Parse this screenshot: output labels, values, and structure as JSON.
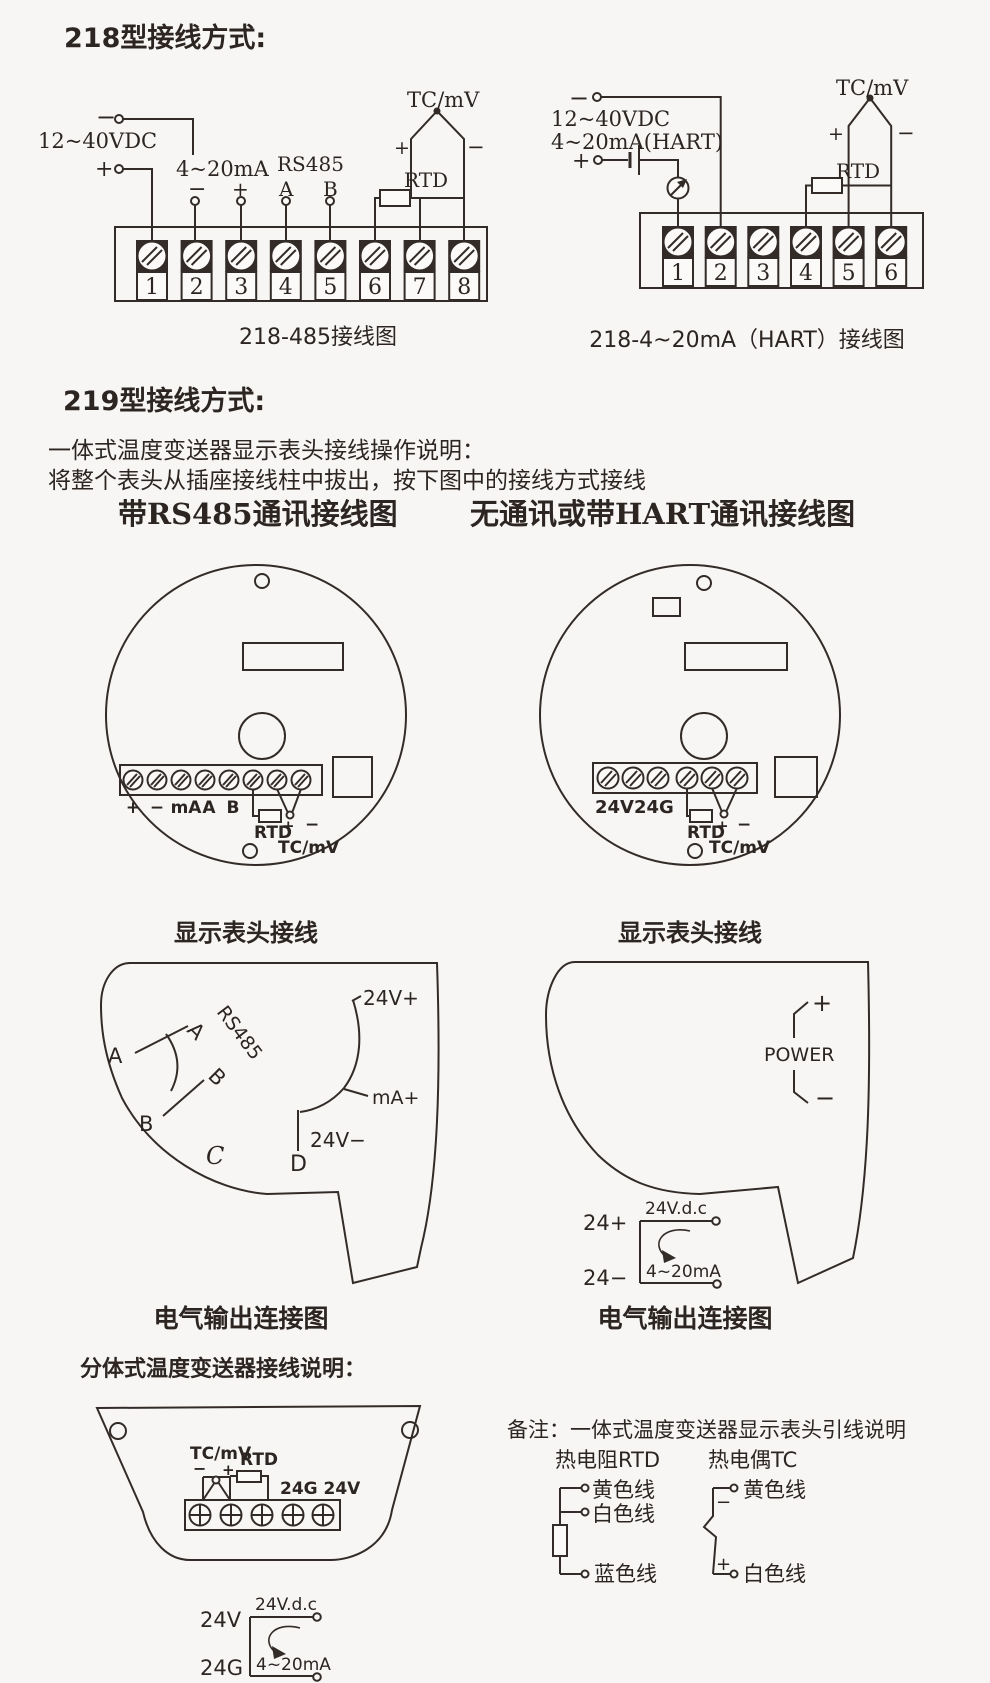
{
  "colors": {
    "ink": "#332b27",
    "bg": "#f7f6f4"
  },
  "s218": {
    "title": "218型接线方式:",
    "left": {
      "caption": "218-485接线图",
      "supply": "12~40VDC",
      "supply_minus": "−",
      "supply_plus": "+",
      "loop": "4~20mA",
      "loop_minus": "−",
      "loop_plus": "+",
      "rs485": "RS485",
      "a": "A",
      "b": "B",
      "tcmv": "TC/mV",
      "tc_plus": "+",
      "tc_minus": "−",
      "rtd": "RTD",
      "terminals": [
        "1",
        "2",
        "3",
        "4",
        "5",
        "6",
        "7",
        "8"
      ]
    },
    "right": {
      "caption": "218-4~20mA（HART）接线图",
      "supply": "12~40VDC",
      "supply2": "4~20mA(HART)",
      "supply_minus": "−",
      "supply_plus": "+",
      "tcmv": "TC/mV",
      "tc_plus": "+",
      "tc_minus": "−",
      "rtd": "RTD",
      "terminals": [
        "1",
        "2",
        "3",
        "4",
        "5",
        "6"
      ]
    }
  },
  "s219": {
    "title": "219型接线方式:",
    "desc1": "一体式温度变送器显示表头接线操作说明：",
    "desc2": "将整个表头从插座接线柱中拔出，按下图中的接线方式接线",
    "left_header": "带RS485通讯接线图",
    "right_header": "无通讯或带HART通讯接线图",
    "head_caption": "显示表头接线",
    "out_caption": "电气输出连接图",
    "left_circle": {
      "t_plus": "+",
      "t_minus": "−",
      "t_ma": "mA",
      "t_a": "A",
      "t_b": "B",
      "rtd": "RTD",
      "plus": "+",
      "minus": "−",
      "tcmv": "TC/mV"
    },
    "right_circle": {
      "pwr": "24V24G",
      "rtd": "RTD",
      "plus": "+",
      "minus": "−",
      "tcmv": "TC/mV"
    },
    "left_out": {
      "a1": "A",
      "a2": "A",
      "rs485": "RS485",
      "b1": "B",
      "b2": "B",
      "c": "C",
      "d": "D",
      "v_plus": "24V+",
      "ma_plus": "mA+",
      "v_minus": "24V−"
    },
    "right_out": {
      "power": "POWER",
      "plus": "+",
      "minus": "−",
      "p24": "24+",
      "n24": "24−",
      "vdc": "24V.d.c",
      "loop": "4~20mA"
    }
  },
  "split": {
    "title": "分体式温度变送器接线说明：",
    "tcmv": "TC/mV",
    "rtd": "RTD",
    "minus": "−",
    "plus": "+",
    "pwr": "24G 24V",
    "v24": "24V",
    "g24": "24G",
    "vdc": "24V.d.c",
    "loop": "4~20mA"
  },
  "note": {
    "title": "备注：一体式温度变送器显示表头引线说明",
    "rtd_header": "热电阻RTD",
    "tc_header": "热电偶TC",
    "rtd_wires": [
      "黄色线",
      "白色线",
      "蓝色线"
    ],
    "tc_wires": [
      "黄色线",
      "白色线"
    ],
    "tc_minus": "−",
    "tc_plus": "+"
  }
}
